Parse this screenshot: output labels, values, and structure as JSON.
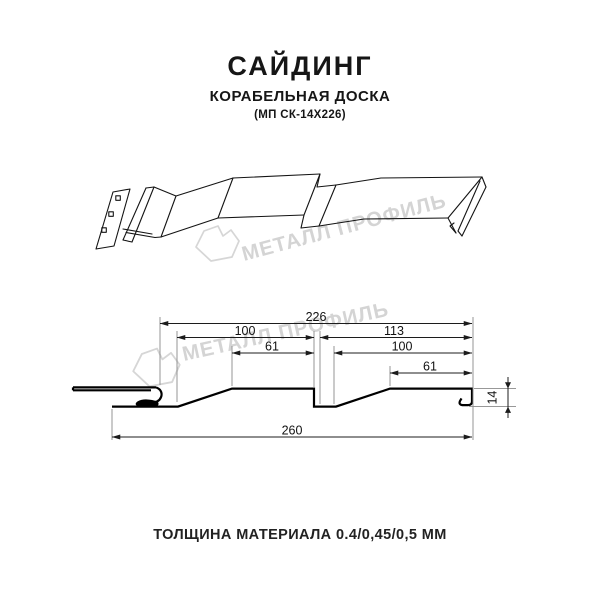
{
  "header": {
    "title": "САЙДИНГ",
    "subtitle": "КОРАБЕЛЬНАЯ ДОСКА",
    "model": "(МП СК-14Х226)"
  },
  "watermark": {
    "brand": "МЕТАЛЛ ПРОФИЛЬ",
    "color": "#d4d4d4"
  },
  "drawing": {
    "dimension_labels": {
      "width_226": "226",
      "left_pitch_100": "100",
      "right_pitch_113": "113",
      "left_flat_61": "61",
      "right_width_100": "100",
      "right_flat_61": "61",
      "overall_260": "260",
      "depth_14": "14"
    }
  },
  "footer": {
    "caption": "ТОЛЩИНА МАТЕРИАЛА 0.4/0,45/0,5 ММ"
  }
}
